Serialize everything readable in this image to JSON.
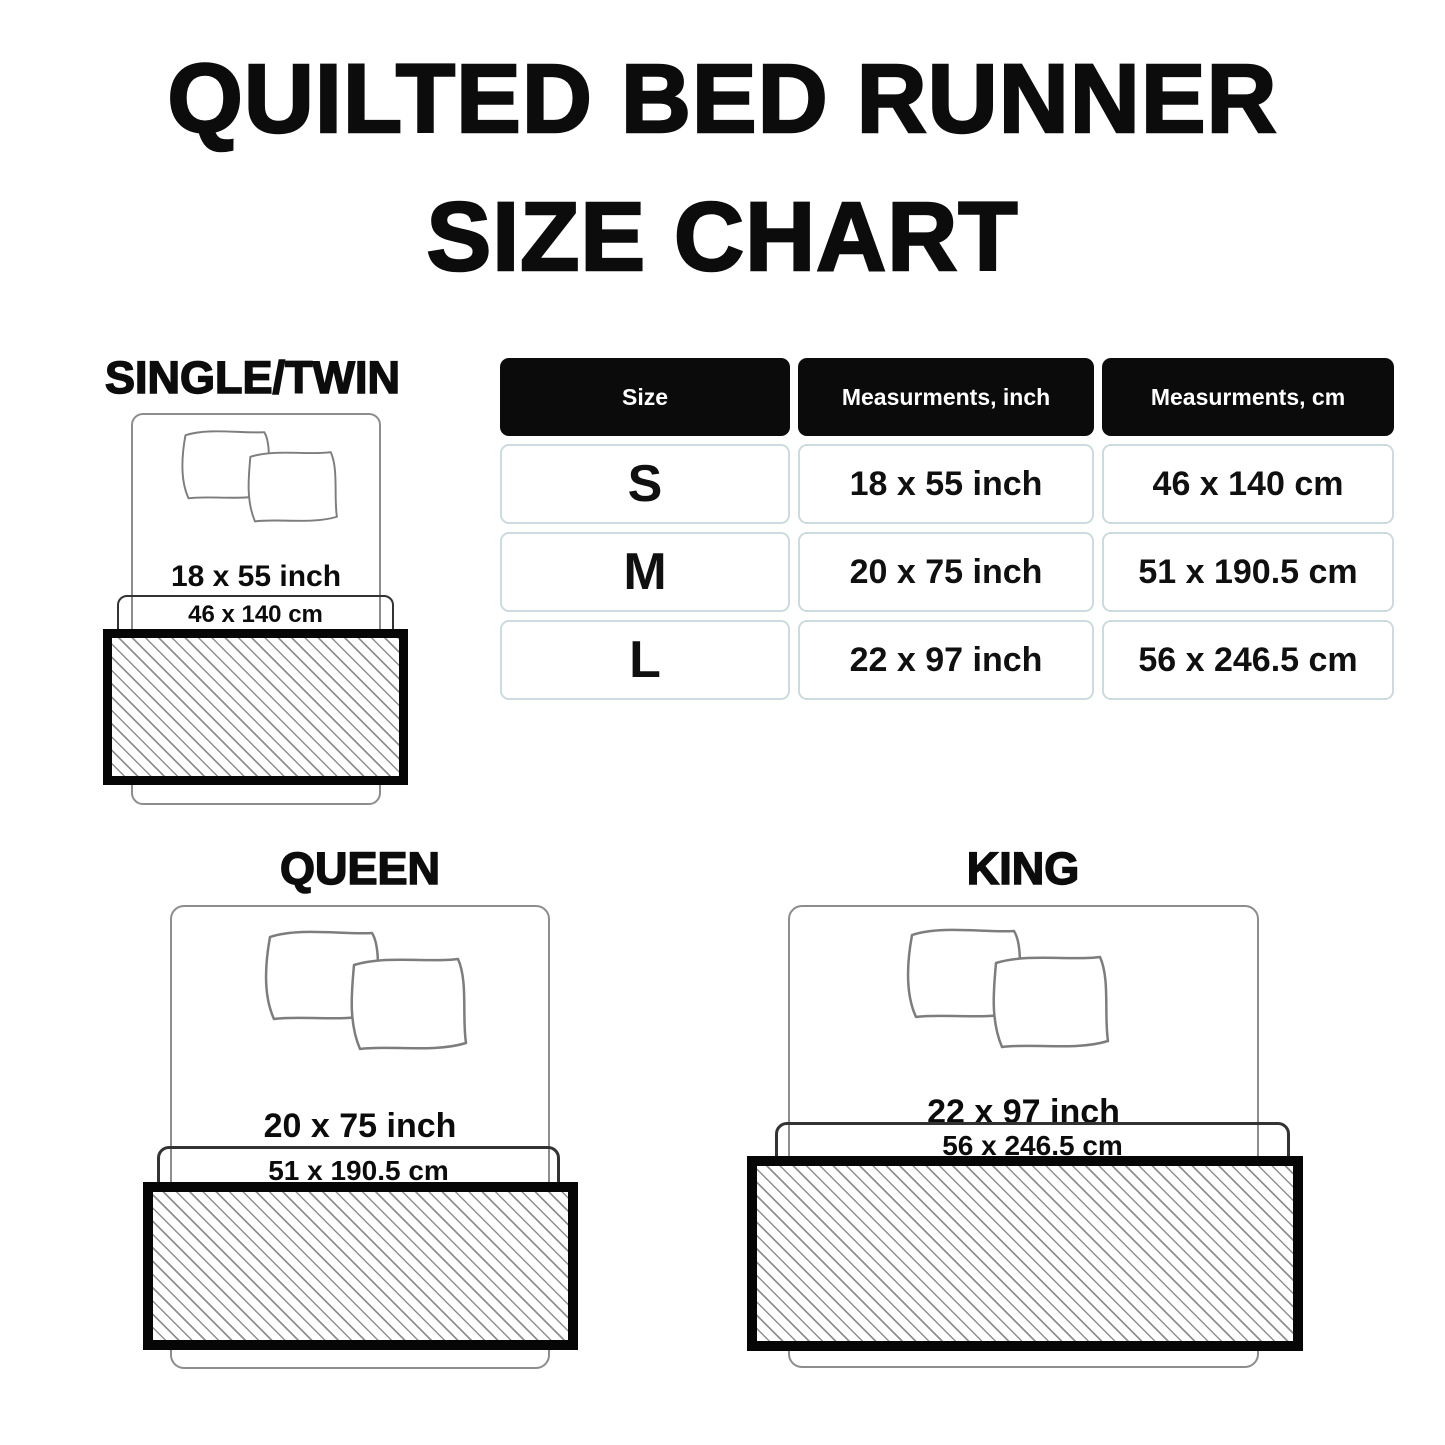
{
  "title": {
    "line1": "QUILTED BED RUNNER",
    "line2": "SIZE CHART"
  },
  "table": {
    "headers": [
      "Size",
      "Measurments, inch",
      "Measurments, cm"
    ],
    "rows": [
      {
        "size": "S",
        "inch": "18 x 55 inch",
        "cm": "46 x 140 cm"
      },
      {
        "size": "M",
        "inch": "20 x 75 inch",
        "cm": "51 x 190.5 cm"
      },
      {
        "size": "L",
        "inch": "22 x 97 inch",
        "cm": "56 x 246.5 cm"
      }
    ]
  },
  "beds": {
    "single": {
      "label": "SINGLE/TWIN",
      "inch": "18 x 55 inch",
      "cm": "46 x 140 cm"
    },
    "queen": {
      "label": "QUEEN",
      "inch": "20 x 75 inch",
      "cm": "51 x 190.5 cm"
    },
    "king": {
      "label": "KING",
      "inch": "22 x 97 inch",
      "cm": "56 x 246.5 cm"
    }
  },
  "colors": {
    "table_header_bg": "#0b0b0b",
    "table_cell_border": "#ccdbe0",
    "outline_gray": "#8d8d8d",
    "runner_border": "#060606",
    "hatch_line": "#8f8f8f"
  }
}
